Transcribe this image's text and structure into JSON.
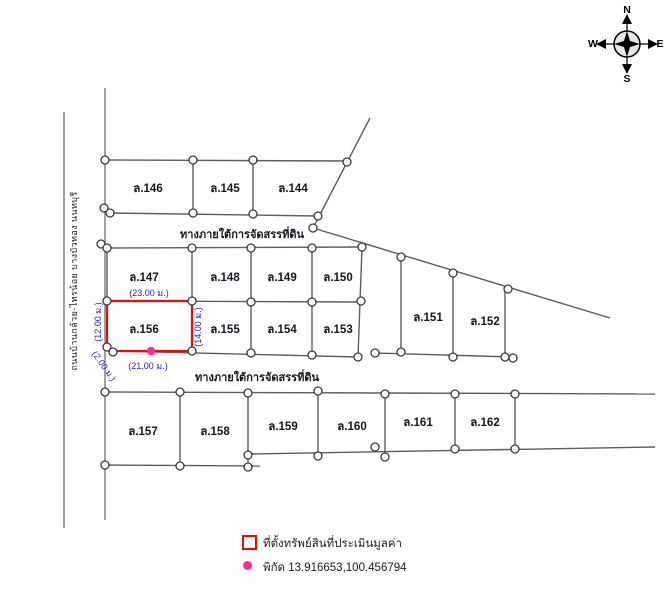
{
  "compass": {
    "north": "N",
    "east": "E",
    "south": "S",
    "west": "W"
  },
  "roads": {
    "upper_label": "ทางภายใต้การจัดสรรที่ดิน",
    "lower_label": "ทางภายใต้การจัดสรรที่ดิน",
    "left_label": "ถนนบ้านกล้วย-ไทรน้อย บางบัวทอง นนทบุรี"
  },
  "plots": {
    "p144": "ล.144",
    "p145": "ล.145",
    "p146": "ล.146",
    "p147": "ล.147",
    "p148": "ล.148",
    "p149": "ล.149",
    "p150": "ล.150",
    "p151": "ล.151",
    "p152": "ล.152",
    "p153": "ล.153",
    "p154": "ล.154",
    "p155": "ล.155",
    "p156": "ล.156",
    "p157": "ล.157",
    "p158": "ล.158",
    "p159": "ล.159",
    "p160": "ล.160",
    "p161": "ล.161",
    "p162": "ล.162"
  },
  "subject": {
    "plot_id": "ล.156",
    "dim_top": "(23.00 ม.)",
    "dim_bottom": "(21.00 ม.)",
    "dim_right": "(14.00 ม.)",
    "dim_left": "(12.00 ม.)",
    "dim_chamfer": "(2.00 ม.)",
    "outline_color": "#ff0000",
    "marker_color": "#ff2d93",
    "dim_color": "#2222cc"
  },
  "legend": {
    "subject_label": "ที่ตั้งทรัพย์สินที่ประเมินมูลค่า",
    "coord_label": "พิกัด",
    "coord_value": "13.916653,100.456794"
  }
}
